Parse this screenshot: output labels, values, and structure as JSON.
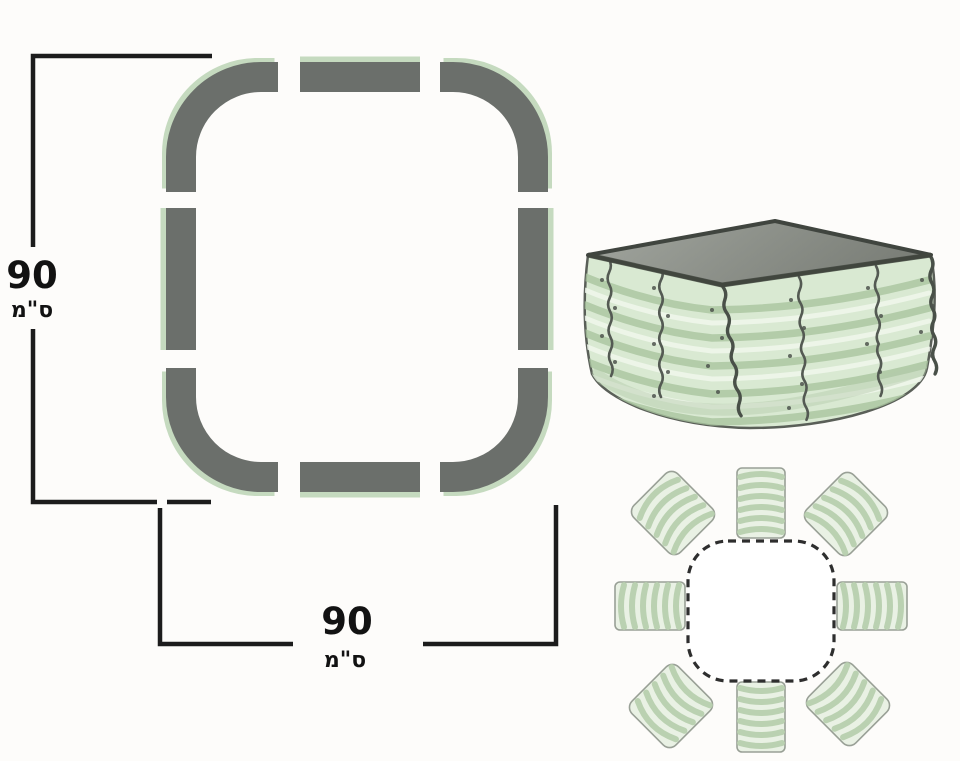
{
  "labels": {
    "height": {
      "value": "90",
      "unit": "ס\"מ"
    },
    "width": {
      "value": "90",
      "unit": "ס\"מ"
    }
  },
  "top_view": {
    "name": "planter-top-view-panel-layout",
    "piece_count": 8,
    "corner_pieces": 4,
    "side_pieces": 4
  },
  "assembled_view": {
    "name": "assembled-corrugated-raised-bed",
    "panel_seams": 6
  },
  "exploded_view": {
    "name": "exploded-top-view",
    "panel_count": 8
  },
  "colors": {
    "panel_gray": "#6b6f6b",
    "panel_edge_green": "#c5dabf",
    "dimension_line": "#1c1c1c",
    "wall_light_green": "#d9e9d2",
    "ridge_green": "#a9c49f",
    "stripe_light": "#e9f1e4",
    "stripe_green": "#b7cfae",
    "interior_gray_dark": "#7b7f78",
    "interior_gray_light": "#a2a69f",
    "dashed_outline": "#2e2e2e"
  }
}
